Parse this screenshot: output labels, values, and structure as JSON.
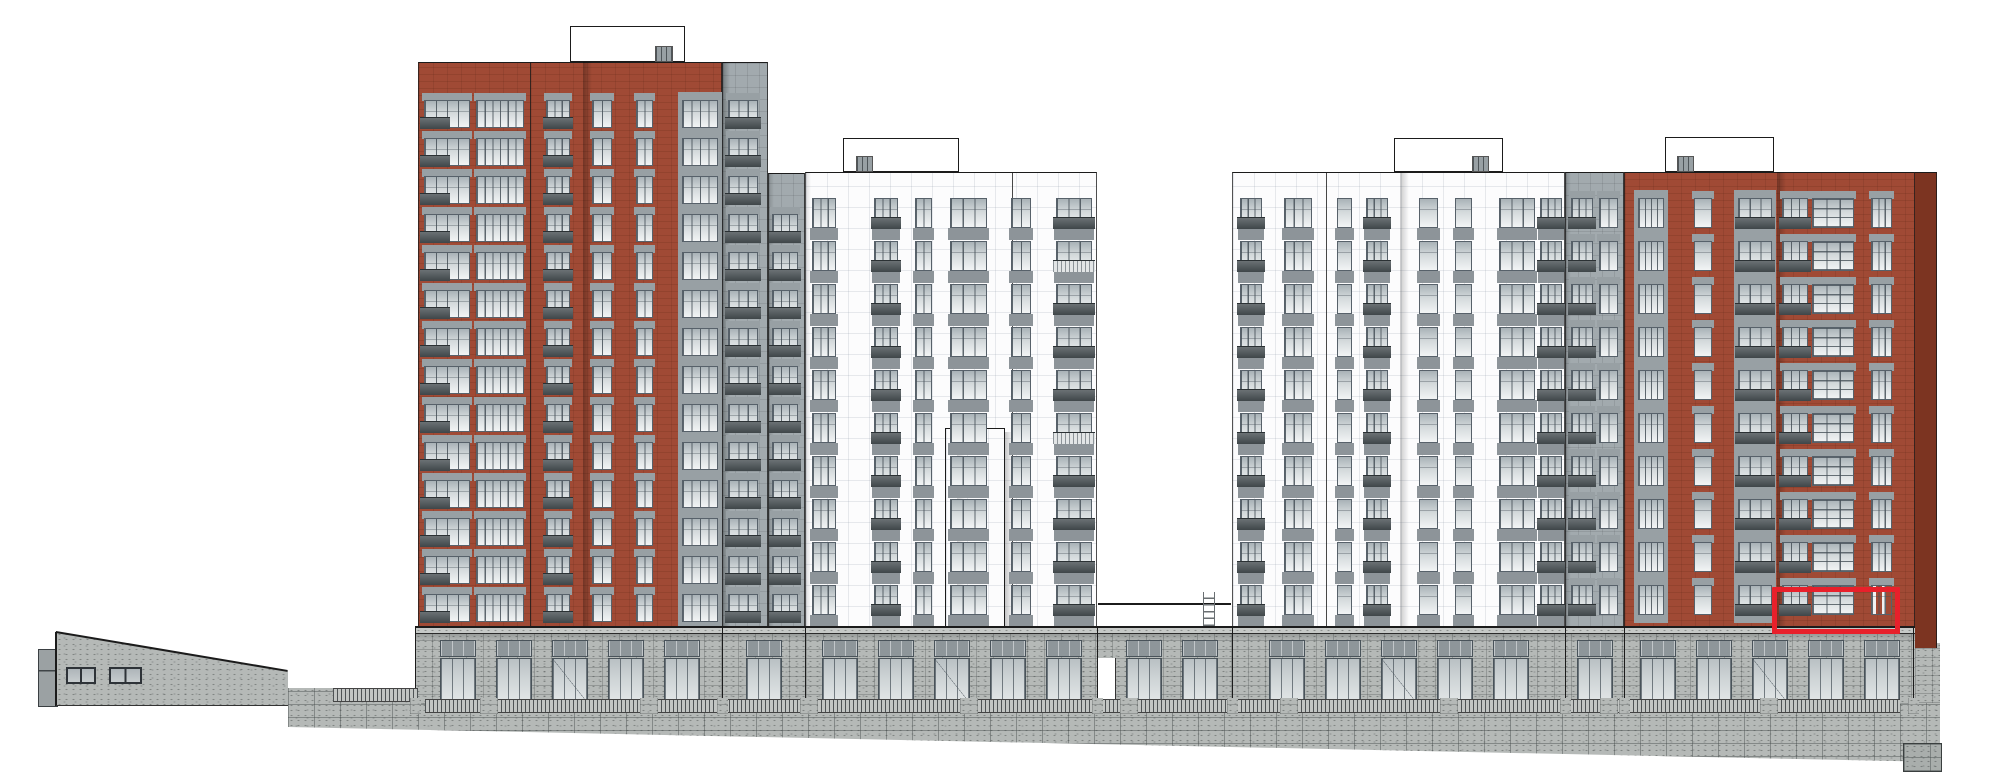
{
  "scene": {
    "w": 2000,
    "h": 780,
    "bg": "#ffffff"
  },
  "palette": {
    "brick": "#a04a35",
    "brick_side": "#7c3421",
    "gray_facade": "#a2aaae",
    "white_facade": "#fcfcfd",
    "glass_top": "#a9b2b7",
    "glass_mid": "#d3d9db",
    "glass_bottom": "#f2f4f5",
    "frame": "#57616a",
    "header_panel": "#98a0a4",
    "spandrel_panel": "#8d9499",
    "balustrade": "#4a5256",
    "balustrade_light": "#e2e5e6",
    "stone": "#b5b9b7",
    "stone_parapet": "#c6c9c7",
    "clerestory": "#8e969a",
    "store_glass": "#ccd2d4",
    "outline": "#1b1b1b",
    "highlight": "#e8202b",
    "ladder": "#6a6f72"
  },
  "highlight": {
    "x": 1772,
    "y": 587,
    "w": 128,
    "h": 47,
    "stroke": 5
  },
  "roof_boxes": [
    {
      "id": "roof-box-1",
      "x": 570,
      "y": 26,
      "w": 115,
      "h": 36
    },
    {
      "id": "roof-box-2",
      "x": 843,
      "y": 138,
      "w": 116,
      "h": 34
    },
    {
      "id": "roof-box-3",
      "x": 1394,
      "y": 138,
      "w": 109,
      "h": 34
    },
    {
      "id": "roof-box-4",
      "x": 1665,
      "y": 137,
      "w": 109,
      "h": 35
    }
  ],
  "chimneys": [
    {
      "x": 655,
      "y": 46,
      "w": 18,
      "h": 16
    },
    {
      "x": 856,
      "y": 156,
      "w": 17,
      "h": 16
    },
    {
      "x": 1472,
      "y": 156,
      "w": 17,
      "h": 16
    },
    {
      "x": 1677,
      "y": 156,
      "w": 17,
      "h": 16
    }
  ],
  "towers": [
    {
      "id": "left-red-tower",
      "x": 418,
      "y": 62,
      "w": 304,
      "h": 566,
      "color": "brick",
      "grid": "brick",
      "rows": {
        "start": 100,
        "pitch": 38,
        "h": 28,
        "count": 14
      },
      "lines": [
        530
      ],
      "shadows": [
        {
          "x": 583,
          "w": 9,
          "a": 0.28
        }
      ],
      "cols": [
        {
          "x": 424,
          "w": 46,
          "t": "balcL"
        },
        {
          "x": 476,
          "w": 48,
          "t": "glass6"
        },
        {
          "x": 546,
          "w": 24,
          "t": "balc3"
        },
        {
          "x": 592,
          "w": 20,
          "t": "glass2"
        },
        {
          "x": 636,
          "w": 17,
          "t": "glass2"
        },
        {
          "x": 682,
          "w": 36,
          "t": "glassH"
        }
      ]
    },
    {
      "id": "left-gray-bay-upper",
      "x": 722,
      "y": 62,
      "w": 46,
      "h": 566,
      "color": "gray_facade",
      "grid": "gray",
      "rows": {
        "start": 100,
        "pitch": 38,
        "h": 28,
        "count": 14
      },
      "shadows": [
        {
          "x": 722,
          "w": 8,
          "a": 0.3
        }
      ],
      "cols": [
        {
          "x": 728,
          "w": 30,
          "t": "balc3"
        }
      ]
    },
    {
      "id": "left-gray-bay-lower",
      "x": 768,
      "y": 173,
      "w": 37,
      "h": 455,
      "color": "gray_facade",
      "grid": "gray",
      "rows": {
        "start": 214,
        "pitch": 38,
        "h": 28,
        "count": 11
      },
      "shadows": [
        {
          "x": 768,
          "w": 6,
          "a": 0.18
        }
      ],
      "cols": [
        {
          "x": 772,
          "w": 26,
          "t": "balc3"
        }
      ]
    },
    {
      "id": "left-white-tower",
      "x": 805,
      "y": 172,
      "w": 292,
      "h": 456,
      "color": "white_facade",
      "grid": "white",
      "rows": {
        "start": 198,
        "pitch": 43,
        "h": 30,
        "count": 10
      },
      "lines": [
        1012
      ],
      "shadows": [
        {
          "x": 806,
          "w": 5,
          "a": 0.12
        },
        {
          "x": 957,
          "w": 8,
          "a": 0.15,
          "y2": 428
        }
      ],
      "protrusion": {
        "x": 945,
        "y": 428,
        "w": 60
      },
      "cols": [
        {
          "x": 812,
          "w": 24,
          "t": "wwide"
        },
        {
          "x": 874,
          "w": 24,
          "t": "wbalc"
        },
        {
          "x": 915,
          "w": 17,
          "t": "wpanel2"
        },
        {
          "x": 950,
          "w": 37,
          "t": "wwide"
        },
        {
          "x": 1011,
          "w": 20,
          "t": "wpanel2"
        },
        {
          "x": 1056,
          "w": 36,
          "t": "wbalc",
          "light": [
            1,
            5
          ]
        }
      ]
    },
    {
      "id": "right-white-tower",
      "x": 1232,
      "y": 172,
      "w": 333,
      "h": 456,
      "color": "white_facade",
      "grid": "white",
      "rows": {
        "start": 198,
        "pitch": 43,
        "h": 30,
        "count": 10
      },
      "lines": [
        1326
      ],
      "shadows": [
        {
          "x": 1400,
          "w": 9,
          "a": 0.2
        }
      ],
      "cols": [
        {
          "x": 1240,
          "w": 22,
          "t": "wbalc"
        },
        {
          "x": 1284,
          "w": 28,
          "t": "wwide"
        },
        {
          "x": 1337,
          "w": 15,
          "t": "wpanel1"
        },
        {
          "x": 1366,
          "w": 22,
          "t": "wbalc"
        },
        {
          "x": 1419,
          "w": 19,
          "t": "wpanel1"
        },
        {
          "x": 1455,
          "w": 17,
          "t": "wpanel1"
        },
        {
          "x": 1499,
          "w": 36,
          "t": "wwide"
        },
        {
          "x": 1540,
          "w": 22,
          "t": "wbalc"
        }
      ]
    },
    {
      "id": "gray-stripe",
      "x": 1565,
      "y": 172,
      "w": 59,
      "h": 456,
      "color": "gray_facade",
      "grid": "gray",
      "rows": {
        "start": 198,
        "pitch": 43,
        "h": 30,
        "count": 10
      },
      "shadows": [
        {
          "x": 1565,
          "w": 6,
          "a": 0.2
        }
      ],
      "cols": [
        {
          "x": 1571,
          "w": 22,
          "t": "balc3"
        },
        {
          "x": 1599,
          "w": 19,
          "t": "glass2"
        }
      ]
    },
    {
      "id": "right-red-tower",
      "x": 1624,
      "y": 172,
      "w": 291,
      "h": 456,
      "color": "brick",
      "grid": "brick",
      "rows": {
        "start": 198,
        "pitch": 43,
        "h": 30,
        "count": 10
      },
      "shadows": [
        {
          "x": 1777,
          "w": 9,
          "a": 0.28
        }
      ],
      "cols": [
        {
          "x": 1638,
          "w": 26,
          "t": "glassH"
        },
        {
          "x": 1694,
          "w": 18,
          "t": "glass1"
        },
        {
          "x": 1738,
          "w": 34,
          "t": "balcH"
        },
        {
          "x": 1782,
          "w": 26,
          "t": "balc3"
        },
        {
          "x": 1812,
          "w": 42,
          "t": "big9"
        },
        {
          "x": 1871,
          "w": 21,
          "t": "glass3",
          "red": [
            9
          ]
        }
      ]
    }
  ],
  "side_return": {
    "x": 1915,
    "y": 172,
    "w": 22,
    "h": 476
  },
  "pavilion": {
    "x": 56,
    "y": 632,
    "w": 232,
    "h": 74,
    "roof_drop": 39,
    "pilaster": {
      "x": 38,
      "y": 649,
      "w": 18,
      "h": 56
    },
    "windows": [
      {
        "x": 66,
        "y": 667,
        "w": 30,
        "h": 17
      },
      {
        "x": 109,
        "y": 667,
        "w": 33,
        "h": 17
      }
    ]
  },
  "podium": {
    "x": 415,
    "x2": 1915,
    "parapet_y": 626,
    "parapet_h": 8,
    "floor_y": 634,
    "floor_h": 70,
    "clerestory_y": 640,
    "clerestory_h": 17,
    "glass_y": 658,
    "glass_h": 45,
    "segments": [
      [
        422,
        718
      ],
      [
        726,
        801
      ],
      [
        809,
        1094
      ],
      [
        1116,
        1228
      ],
      [
        1236,
        1561
      ],
      [
        1569,
        1620
      ],
      [
        1628,
        1911
      ]
    ],
    "boundaries": [
      415,
      722,
      805,
      1097,
      1232,
      1565,
      1624,
      1913
    ],
    "passage": {
      "x": 1097,
      "w": 17,
      "y": 658,
      "h": 46
    },
    "right_stone": {
      "x": 1915,
      "y": 643,
      "w": 25,
      "h": 60
    }
  },
  "fence": {
    "x": 425,
    "x2": 1900,
    "y": 699,
    "h": 14,
    "left_piece": {
      "x": 333,
      "x2": 418,
      "y": 688,
      "h": 14
    }
  },
  "retaining_wall": {
    "x": 288,
    "y": 688,
    "w": 1652,
    "h": 82,
    "clip": [
      [
        0,
        0
      ],
      [
        130,
        0
      ],
      [
        130,
        14
      ],
      [
        1652,
        14
      ],
      [
        1652,
        74
      ],
      [
        0,
        39
      ]
    ],
    "right_block": {
      "x": 1903,
      "y": 743,
      "w": 37,
      "h": 27
    }
  },
  "connector": {
    "x1": 1098,
    "x2": 1231,
    "y": 603
  },
  "ladder": {
    "x": 1203,
    "y": 592,
    "w": 12,
    "h": 34,
    "rungs": 5
  }
}
